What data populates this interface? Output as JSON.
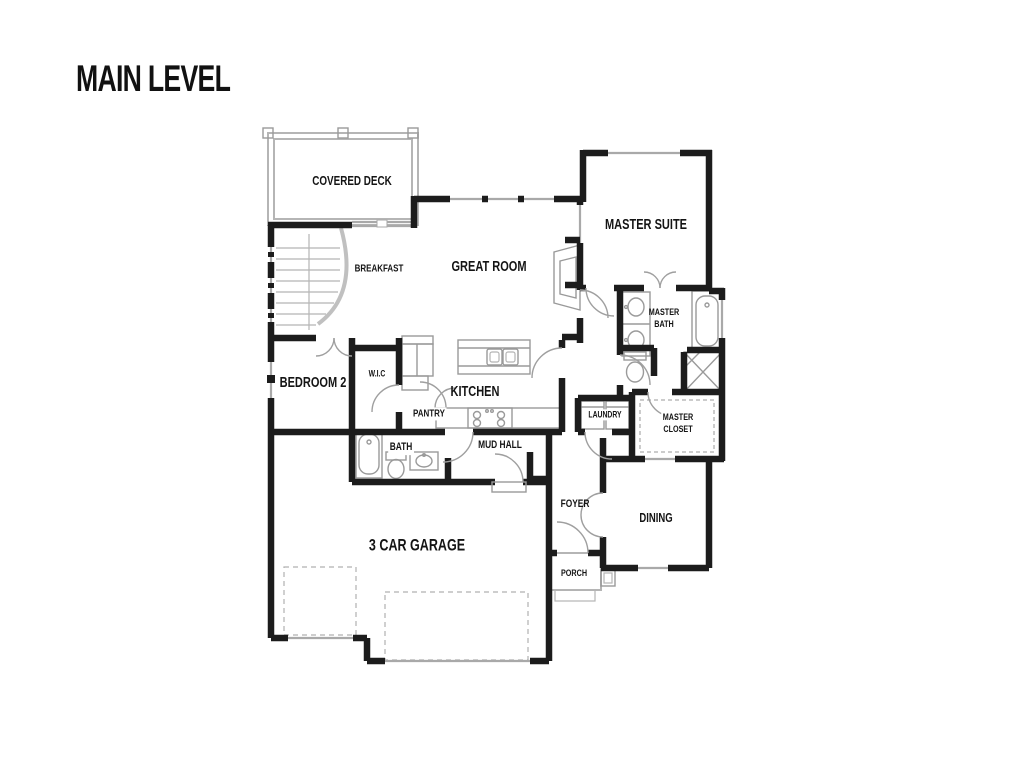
{
  "page": {
    "title": "MAIN LEVEL"
  },
  "colors": {
    "wall": "#1c1c1c",
    "thin_line": "#9a9a9a",
    "light_line": "#b5b5b5",
    "text": "#141414",
    "background": "#ffffff"
  },
  "rooms": {
    "covered_deck": {
      "label": "COVERED DECK"
    },
    "breakfast": {
      "label": "BREAKFAST"
    },
    "great_room": {
      "label": "GREAT ROOM"
    },
    "master_suite": {
      "label": "MASTER SUITE"
    },
    "master_bath": {
      "label_line1": "MASTER",
      "label_line2": "BATH"
    },
    "bedroom_2": {
      "label": "BEDROOM 2"
    },
    "wic": {
      "label": "W.I.C"
    },
    "pantry": {
      "label": "PANTRY"
    },
    "kitchen": {
      "label": "KITCHEN"
    },
    "laundry": {
      "label": "LAUNDRY"
    },
    "master_closet": {
      "label_line1": "MASTER",
      "label_line2": "CLOSET"
    },
    "bath": {
      "label": "BATH"
    },
    "mud_hall": {
      "label": "MUD HALL"
    },
    "garage": {
      "label": "3 CAR GARAGE"
    },
    "foyer": {
      "label": "FOYER"
    },
    "dining": {
      "label": "DINING"
    },
    "porch": {
      "label": "PORCH"
    }
  }
}
